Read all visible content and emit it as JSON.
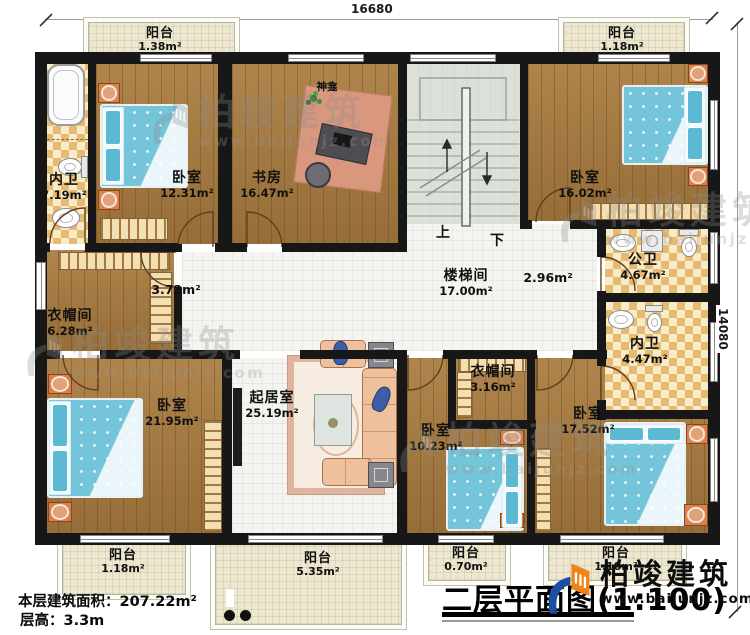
{
  "dimensions": {
    "top": "16680",
    "right": "14080"
  },
  "rooms": {
    "balcony_tl": {
      "label": "阳台",
      "area": "1.38m²"
    },
    "balcony_tr": {
      "label": "阳台",
      "area": "1.18m²"
    },
    "bath_tl": {
      "label": "内卫",
      "area": "7.19m²"
    },
    "bedroom_12": {
      "label": "卧室",
      "area": "12.31m²"
    },
    "study": {
      "label": "书房",
      "area": "16.47m²"
    },
    "stairwell": {
      "label": "楼梯间",
      "area": "17.00m²"
    },
    "bedroom_16": {
      "label": "卧室",
      "area": "16.02m²"
    },
    "cloakroom_6": {
      "label": "衣帽间",
      "area": "6.28m²"
    },
    "public_bath": {
      "label": "公卫",
      "area": "4.67m²"
    },
    "bath_447": {
      "label": "内卫",
      "area": "4.47m²"
    },
    "bedroom_21": {
      "label": "卧室",
      "area": "21.95m²"
    },
    "living": {
      "label": "起居室",
      "area": "25.19m²"
    },
    "cloakroom_3": {
      "label": "衣帽间",
      "area": "3.16m²"
    },
    "bedroom_10": {
      "label": "卧室",
      "area": "10.23m²"
    },
    "bedroom_17": {
      "label": "卧室",
      "area": "17.52m²"
    },
    "balcony_bl": {
      "label": "阳台",
      "area": "1.18m²"
    },
    "balcony_bc": {
      "label": "阳台",
      "area": "5.35m²"
    },
    "balcony_b07": {
      "label": "阳台",
      "area": "0.70m²"
    },
    "balcony_br": {
      "label": "阳台",
      "area": "1.18m²"
    }
  },
  "halls": {
    "h372": "3.72m²",
    "h296": "2.96m²"
  },
  "annotations": {
    "shrine": "神龛",
    "stairs_up": "上",
    "stairs_down": "下"
  },
  "info": {
    "floor_area": "本层建筑面积：207.22m²",
    "floor_height": "层高：3.3m"
  },
  "title": {
    "text": "二层平面图(1:100)"
  },
  "brand": {
    "name": "柏竣建筑",
    "url": "www.baijunjz.com"
  }
}
